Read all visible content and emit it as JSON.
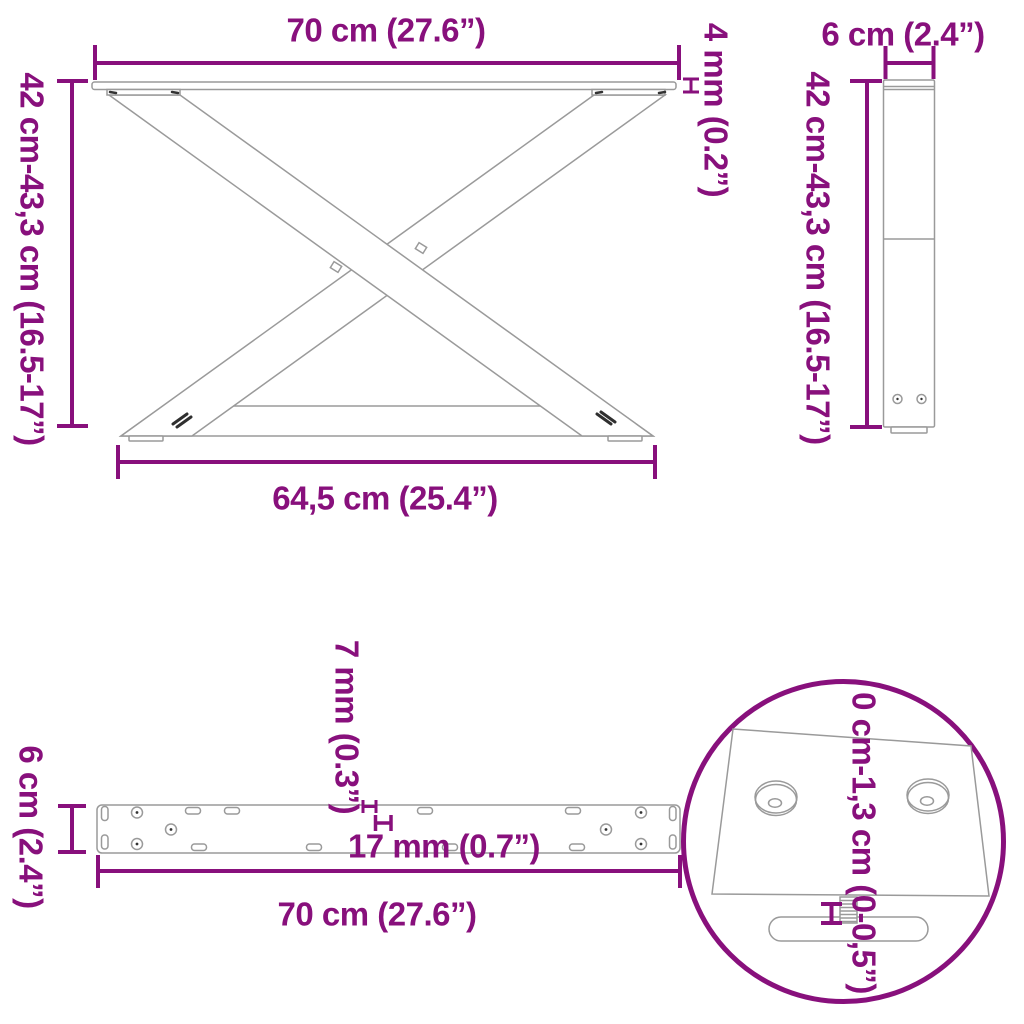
{
  "title": "Table legs dimension diagram",
  "colors": {
    "annotation": "#88107C",
    "line_art": "#9a9a9a",
    "dark_detail": "#333333",
    "background": "#ffffff"
  },
  "views": {
    "front_view": {
      "label_width_top": "70 cm (27.6”)",
      "label_height_left": "42 cm-43,3 cm (16.5-17”)",
      "label_plate_thickness": "4 mm (0.2”)",
      "label_width_bottom": "64,5 cm (25.4”)"
    },
    "side_view": {
      "label_depth_top": "6 cm (2.4”)",
      "label_height_left": "42 cm-43,3 cm (16.5-17”)"
    },
    "plate_top_view": {
      "label_depth_left": "6 cm (2.4”)",
      "label_slot_width": "7 mm (0.3”)",
      "label_hole_diameter": "17 mm (0.7”)",
      "label_width_bottom": "70 cm (27.6”)"
    },
    "foot_detail_view": {
      "label_adjustable_height": "0 cm-1,3 cm (0-0,5”)"
    }
  }
}
